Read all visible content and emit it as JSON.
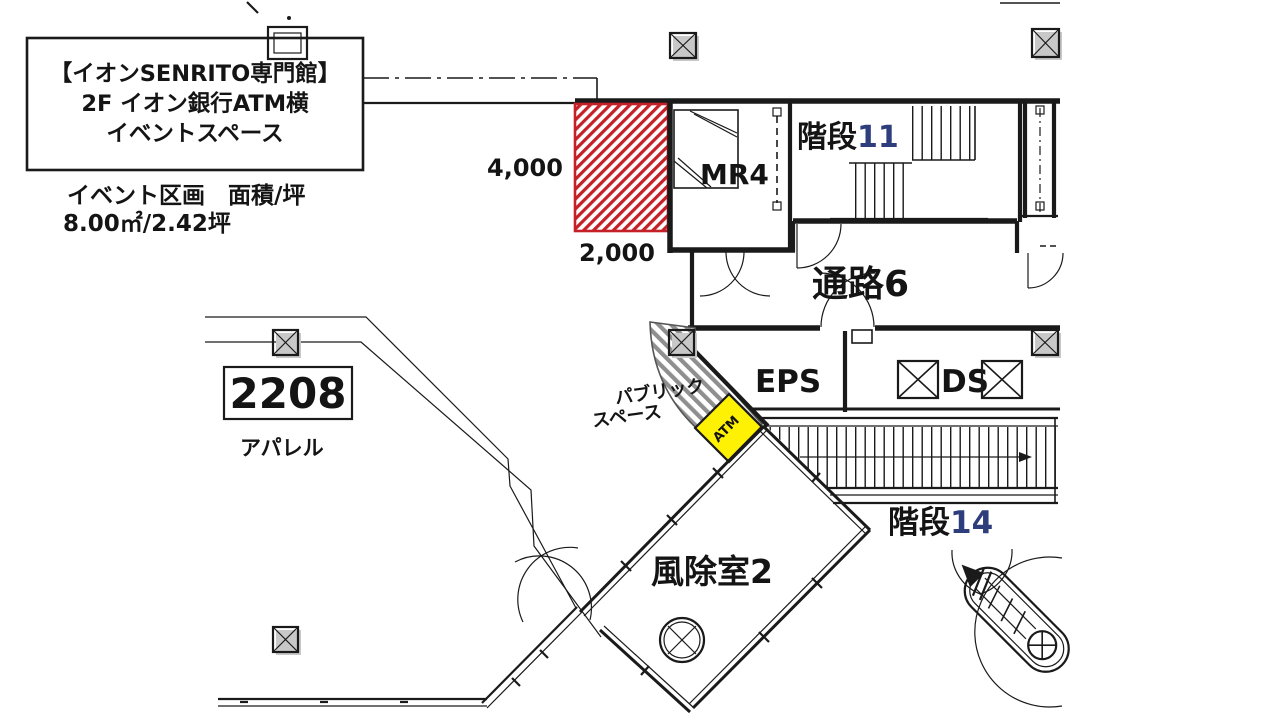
{
  "legend": {
    "title1": "【イオンSENRITO専門館】",
    "title2": "2F イオン銀行ATM横",
    "title3": "イベントスペース",
    "area_caption": "イベント区画　面積/坪",
    "area_value": "8.00㎡/2.42坪"
  },
  "event_space": {
    "dim_height": "4,000",
    "dim_width": "2,000"
  },
  "labels": {
    "mr4": "MR4",
    "stairs11_name": "階段",
    "stairs11_num": "11",
    "corridor6": "通路6",
    "eps": "EPS",
    "ds": "DS",
    "stairs14_name": "階段",
    "stairs14_num": "14",
    "windbreak2": "風除室2",
    "public1": "パブリック",
    "public2": "スペース",
    "atm": "ATM",
    "unit_no": "2208",
    "unit_type": "アパレル"
  },
  "colors": {
    "hatch_red": "#c42028",
    "atm_yellow": "#fff104",
    "stair_num_blue": "#2e3e7c",
    "hatch_gray": "#8f8f8f",
    "shadow_gray": "#c8c8c8",
    "line_black": "#1a1a1a"
  }
}
